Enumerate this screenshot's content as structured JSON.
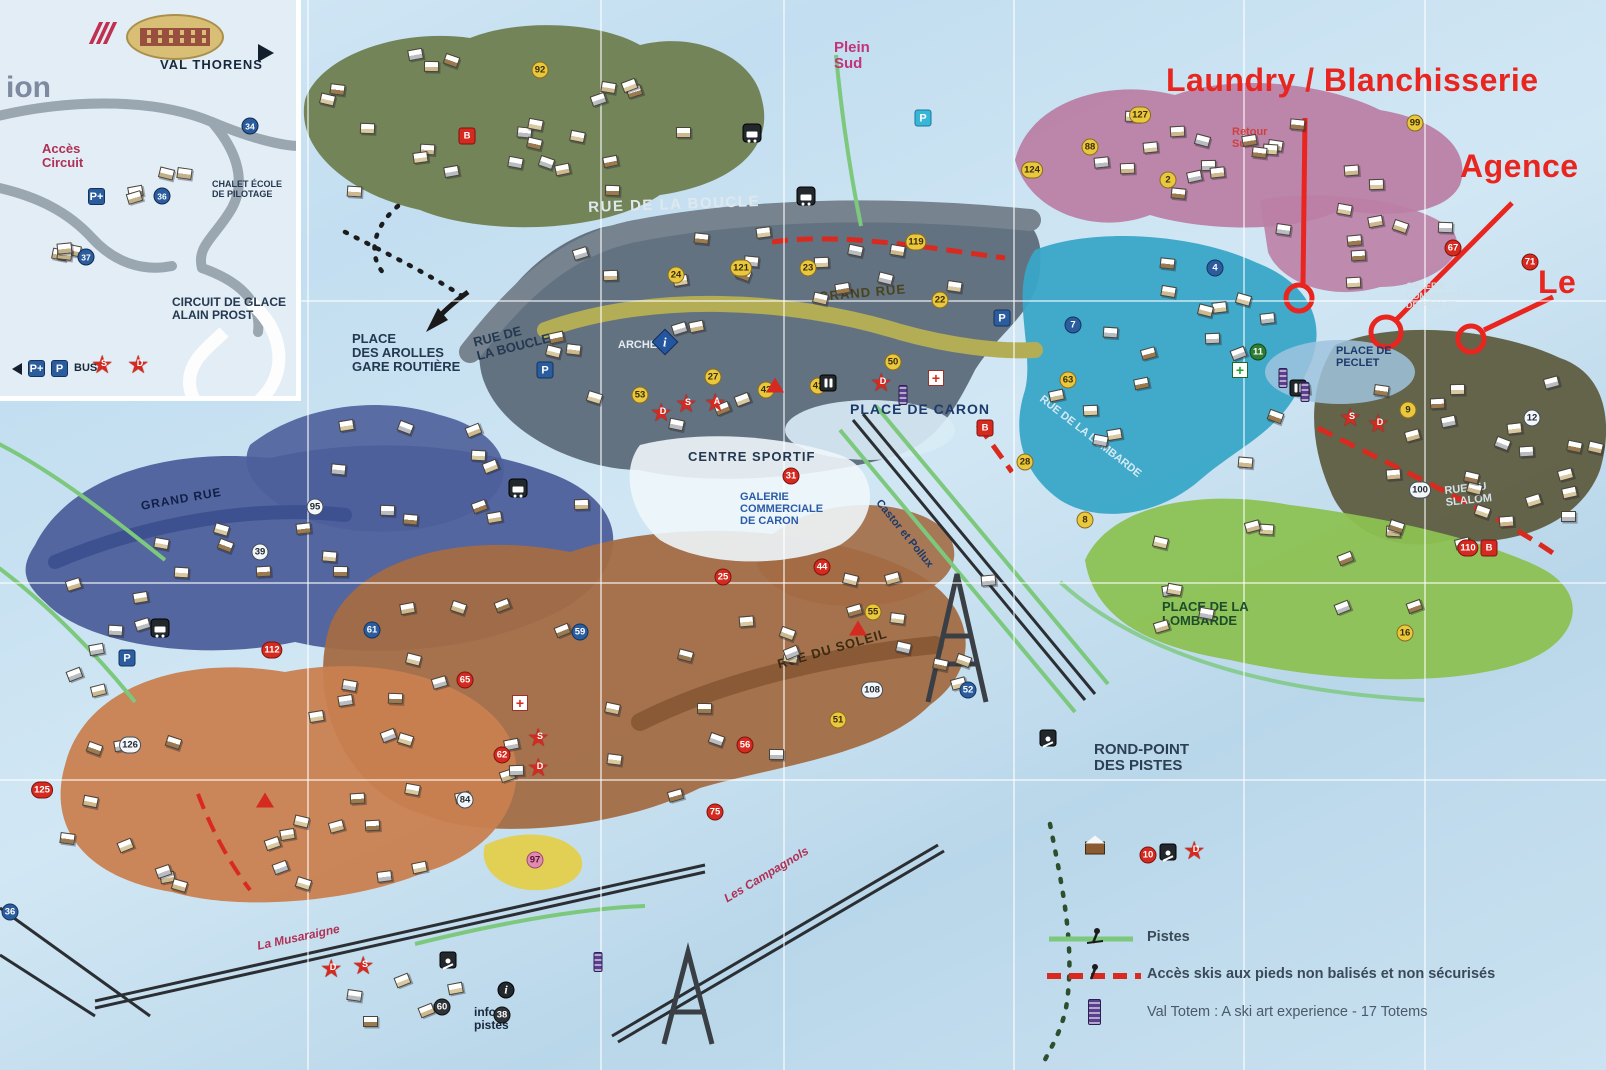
{
  "annotations": {
    "laundry": "Laundry / Blanchisserie",
    "agence": "Agence",
    "le": "Le"
  },
  "inset": {
    "val_thorens": "VAL THORENS",
    "partial_left": "ion",
    "acces_circuit": "Accès\nCircuit",
    "chalet_ecole": "CHALET ÉCOLE\nDE PILOTAGE",
    "circuit_glace": "CIRCUIT DE GLACE\nALAIN PROST",
    "p_plus": "P+",
    "p": "P",
    "bus": "BUS",
    "numbers": [
      {
        "n": "34",
        "x": 250,
        "y": 126
      },
      {
        "n": "36",
        "x": 162,
        "y": 196
      },
      {
        "n": "37",
        "x": 86,
        "y": 257
      }
    ],
    "stars": [
      {
        "l": "S",
        "x": 104,
        "y": 369
      },
      {
        "l": "D",
        "x": 140,
        "y": 369
      }
    ]
  },
  "legend": {
    "items": [
      {
        "type": "piste",
        "text": "Pistes"
      },
      {
        "type": "acces",
        "text": "Accès skis aux pieds non balisés et non sécurisés"
      },
      {
        "type": "totem",
        "text": "Val Totem : A ski art experience - 17 Totems"
      }
    ]
  },
  "zone_colors": {
    "olive": "#6f7e50",
    "pink": "#bb7fa5",
    "gray": "#5d6b7a",
    "cyan": "#39a6c8",
    "olive_dark": "#5e5d40",
    "green": "#8cc152",
    "blue": "#4d5f9a",
    "brown": "#a36c45",
    "orange": "#c9804f",
    "yellow": "#e3cf4a",
    "plaza": "#d8ecf6",
    "plaza2": "#eef6fb",
    "plaza3": "#9fc4de",
    "road_gray": "#77848f",
    "grand_rue_band": "#b3ad56",
    "soleil_road": "#8a5a36",
    "left_road": "#3d5090",
    "piste_green": "#7cc87c",
    "lift_black": "#2b2f33",
    "annotation_red": "#e8251f",
    "dash_red": "#d92a20",
    "footprint_black": "#1c1c1c",
    "footprint_green": "#2e4e2e"
  },
  "render": {
    "labels": [
      {
        "t": "RUE DE LA BOUCLE",
        "x": 588,
        "y": 200,
        "s": 15,
        "c": "#dfe8ee",
        "r": -2,
        "ls": 1.5
      },
      {
        "t": "GRAND RUE",
        "x": 818,
        "y": 290,
        "s": 13,
        "c": "#4a431a",
        "r": -5,
        "ls": 1
      },
      {
        "t": "RUE DE\nLA BOUCLE",
        "x": 472,
        "y": 336,
        "s": 13,
        "c": "#243850",
        "r": -14
      },
      {
        "t": "PLACE\nDES AROLLES\nGARE ROUTIÈRE",
        "x": 352,
        "y": 332,
        "s": 13,
        "c": "#243850"
      },
      {
        "t": "ARCHE",
        "x": 618,
        "y": 340,
        "s": 11,
        "c": "#e4ecf2"
      },
      {
        "t": "PLACE DE CARON",
        "x": 850,
        "y": 402,
        "s": 14,
        "c": "#1c3a6b",
        "ls": 1
      },
      {
        "t": "CENTRE SPORTIF",
        "x": 688,
        "y": 450,
        "s": 13,
        "c": "#243850",
        "ls": 1
      },
      {
        "t": "GALERIE\nCOMMERCIALE\nDE CARON",
        "x": 740,
        "y": 492,
        "s": 11,
        "c": "#2a5ba8"
      },
      {
        "t": "RUE DE LA LOMBARDE",
        "x": 1044,
        "y": 394,
        "s": 11,
        "c": "#d6eaf4",
        "r": 38
      },
      {
        "t": "PLACE DE\nPECLET",
        "x": 1336,
        "y": 346,
        "s": 11,
        "c": "#1c3a6b"
      },
      {
        "t": "GALERIE\nCOMMERCIALE\nDE PECLET",
        "x": 1406,
        "y": 282,
        "s": 9,
        "c": "#cfe0ea"
      },
      {
        "t": "RUE DU\nSLALOM",
        "x": 1444,
        "y": 486,
        "s": 11,
        "c": "#d6e2ea",
        "r": -6
      },
      {
        "t": "RUE DU SOLEIL",
        "x": 776,
        "y": 658,
        "s": 13,
        "c": "#3a2a12",
        "r": -16,
        "ls": 1
      },
      {
        "t": "PLACE DE LA\nLOMBARDE",
        "x": 1162,
        "y": 600,
        "s": 13,
        "c": "#1d4d2a"
      },
      {
        "t": "ROND-POINT\nDES PISTES",
        "x": 1094,
        "y": 742,
        "s": 15,
        "c": "#2d3f54"
      },
      {
        "t": "Plein\nSud",
        "x": 834,
        "y": 40,
        "s": 15,
        "c": "#c2337a"
      },
      {
        "t": "Retour\nSud",
        "x": 1232,
        "y": 127,
        "s": 11,
        "c": "#cf4040"
      },
      {
        "t": "infos\npistes",
        "x": 474,
        "y": 1006,
        "s": 12,
        "c": "#16283a"
      },
      {
        "t": "La Musaraigne",
        "x": 256,
        "y": 940,
        "s": 12,
        "c": "#b03055",
        "r": -12,
        "i": 1
      },
      {
        "t": "Les Campagnols",
        "x": 722,
        "y": 894,
        "s": 12,
        "c": "#b03055",
        "r": -31,
        "i": 1
      },
      {
        "t": "Castor et Pollux",
        "x": 882,
        "y": 498,
        "s": 11,
        "c": "#1c3a6b",
        "r": 51
      },
      {
        "t": "GRAND RUE",
        "x": 140,
        "y": 500,
        "s": 12,
        "c": "#101f46",
        "r": -10,
        "ls": 1
      }
    ],
    "building_markers": [
      {
        "n": "92",
        "x": 540,
        "y": 70,
        "c": "y"
      },
      {
        "n": "119",
        "x": 916,
        "y": 242,
        "c": "y"
      },
      {
        "n": "121",
        "x": 741,
        "y": 268,
        "c": "y"
      },
      {
        "n": "24",
        "x": 676,
        "y": 275,
        "c": "y"
      },
      {
        "n": "23",
        "x": 808,
        "y": 268,
        "c": "y"
      },
      {
        "n": "22",
        "x": 940,
        "y": 300,
        "c": "y"
      },
      {
        "n": "127",
        "x": 1140,
        "y": 115,
        "c": "y"
      },
      {
        "n": "88",
        "x": 1090,
        "y": 147,
        "c": "y"
      },
      {
        "n": "124",
        "x": 1032,
        "y": 170,
        "c": "y"
      },
      {
        "n": "2",
        "x": 1168,
        "y": 180,
        "c": "y"
      },
      {
        "n": "99",
        "x": 1415,
        "y": 123,
        "c": "y"
      },
      {
        "n": "67",
        "x": 1453,
        "y": 248,
        "c": "r"
      },
      {
        "n": "71",
        "x": 1530,
        "y": 262,
        "c": "r"
      },
      {
        "n": "4",
        "x": 1215,
        "y": 268,
        "c": "b"
      },
      {
        "n": "7",
        "x": 1073,
        "y": 325,
        "c": "b"
      },
      {
        "n": "63",
        "x": 1068,
        "y": 380,
        "c": "y"
      },
      {
        "n": "11",
        "x": 1258,
        "y": 352,
        "c": "g"
      },
      {
        "n": "50",
        "x": 893,
        "y": 362,
        "c": "y"
      },
      {
        "n": "41",
        "x": 818,
        "y": 386,
        "c": "y"
      },
      {
        "n": "42",
        "x": 766,
        "y": 390,
        "c": "y"
      },
      {
        "n": "53",
        "x": 640,
        "y": 395,
        "c": "y"
      },
      {
        "n": "27",
        "x": 713,
        "y": 377,
        "c": "y"
      },
      {
        "n": "31",
        "x": 791,
        "y": 476,
        "c": "r"
      },
      {
        "n": "25",
        "x": 723,
        "y": 577,
        "c": "r"
      },
      {
        "n": "44",
        "x": 822,
        "y": 567,
        "c": "r"
      },
      {
        "n": "95",
        "x": 315,
        "y": 507,
        "c": "w"
      },
      {
        "n": "39",
        "x": 260,
        "y": 552,
        "c": "w"
      },
      {
        "n": "55",
        "x": 873,
        "y": 612,
        "c": "y"
      },
      {
        "n": "28",
        "x": 1025,
        "y": 462,
        "c": "y"
      },
      {
        "n": "8",
        "x": 1085,
        "y": 520,
        "c": "y"
      },
      {
        "n": "16",
        "x": 1405,
        "y": 633,
        "c": "y"
      },
      {
        "n": "9",
        "x": 1408,
        "y": 410,
        "c": "y"
      },
      {
        "n": "100",
        "x": 1420,
        "y": 490,
        "c": "w"
      },
      {
        "n": "110",
        "x": 1468,
        "y": 548,
        "c": "r"
      },
      {
        "n": "12",
        "x": 1532,
        "y": 418,
        "c": "w"
      },
      {
        "n": "61",
        "x": 372,
        "y": 630,
        "c": "b"
      },
      {
        "n": "59",
        "x": 580,
        "y": 632,
        "c": "b"
      },
      {
        "n": "112",
        "x": 272,
        "y": 650,
        "c": "r"
      },
      {
        "n": "65",
        "x": 465,
        "y": 680,
        "c": "r"
      },
      {
        "n": "62",
        "x": 502,
        "y": 755,
        "c": "r"
      },
      {
        "n": "84",
        "x": 465,
        "y": 800,
        "c": "w"
      },
      {
        "n": "56",
        "x": 745,
        "y": 745,
        "c": "r"
      },
      {
        "n": "51",
        "x": 838,
        "y": 720,
        "c": "y"
      },
      {
        "n": "108",
        "x": 872,
        "y": 690,
        "c": "w"
      },
      {
        "n": "52",
        "x": 968,
        "y": 690,
        "c": "b"
      },
      {
        "n": "75",
        "x": 715,
        "y": 812,
        "c": "r"
      },
      {
        "n": "97",
        "x": 535,
        "y": 860,
        "c": "p"
      },
      {
        "n": "126",
        "x": 130,
        "y": 745,
        "c": "w"
      },
      {
        "n": "125",
        "x": 42,
        "y": 790,
        "c": "r"
      },
      {
        "n": "10",
        "x": 1148,
        "y": 855,
        "c": "r"
      },
      {
        "n": "38",
        "x": 502,
        "y": 1015,
        "c": "dk"
      },
      {
        "n": "60",
        "x": 442,
        "y": 1007,
        "c": "dk"
      },
      {
        "n": "36",
        "x": 10,
        "y": 912,
        "c": "b"
      },
      {
        "n": "B",
        "x": 467,
        "y": 136,
        "c": "rs"
      },
      {
        "n": "B",
        "x": 985,
        "y": 428,
        "c": "rs"
      },
      {
        "n": "B",
        "x": 1489,
        "y": 548,
        "c": "rs"
      }
    ],
    "marker_colors": {
      "y": {
        "bg": "#e9c83d",
        "fg": "#3a2c0a",
        "bd": "#8a6d1f"
      },
      "r": {
        "bg": "#d42a20",
        "fg": "#ffffff",
        "bd": "#7e1410"
      },
      "w": {
        "bg": "#f4f7f9",
        "fg": "#222a33",
        "bd": "#44505c"
      },
      "b": {
        "bg": "#2b5d9e",
        "fg": "#ffffff",
        "bd": "#16345e"
      },
      "dk": {
        "bg": "#2e3338",
        "fg": "#ffffff",
        "bd": "#111111"
      },
      "g": {
        "bg": "#2e7d32",
        "fg": "#ffffff",
        "bd": "#14481a"
      },
      "p": {
        "bg": "#e08cb0",
        "fg": "#5e1030",
        "bd": "#a04a72"
      },
      "rs": {
        "bg": "#d42a20",
        "fg": "#ffffff",
        "bd": "#7e1410"
      }
    },
    "stars": [
      {
        "l": "D",
        "x": 663,
        "y": 417
      },
      {
        "l": "S",
        "x": 688,
        "y": 408
      },
      {
        "l": "A",
        "x": 717,
        "y": 407
      },
      {
        "l": "D",
        "x": 883,
        "y": 387
      },
      {
        "l": "S",
        "x": 540,
        "y": 742
      },
      {
        "l": "D",
        "x": 540,
        "y": 772
      },
      {
        "l": "D",
        "x": 333,
        "y": 973
      },
      {
        "l": "S",
        "x": 365,
        "y": 970
      },
      {
        "l": "S",
        "x": 1352,
        "y": 422
      },
      {
        "l": "D",
        "x": 1380,
        "y": 428
      },
      {
        "l": "D",
        "x": 1196,
        "y": 855
      }
    ],
    "triangles": [
      {
        "x": 775,
        "y": 385
      },
      {
        "x": 858,
        "y": 628
      },
      {
        "x": 265,
        "y": 800
      }
    ],
    "icons": {
      "parking": [
        {
          "x": 545,
          "y": 370,
          "label": "P"
        },
        {
          "x": 923,
          "y": 118,
          "label": "P",
          "variant": "cyan"
        },
        {
          "x": 127,
          "y": 658,
          "label": "P"
        },
        {
          "x": 1002,
          "y": 318,
          "label": "P"
        }
      ],
      "bus": [
        {
          "x": 752,
          "y": 133
        },
        {
          "x": 806,
          "y": 196
        },
        {
          "x": 160,
          "y": 628
        },
        {
          "x": 518,
          "y": 488
        }
      ],
      "wc": [
        {
          "x": 828,
          "y": 383
        },
        {
          "x": 1298,
          "y": 388
        }
      ],
      "aid": [
        {
          "x": 936,
          "y": 378
        },
        {
          "x": 520,
          "y": 703
        }
      ],
      "pharmacy": [
        {
          "x": 1240,
          "y": 370
        }
      ],
      "info_diamond": [
        {
          "x": 665,
          "y": 342
        }
      ],
      "info_circle": [
        {
          "x": 506,
          "y": 990
        }
      ],
      "totem": [
        {
          "x": 903,
          "y": 395
        },
        {
          "x": 1283,
          "y": 378
        },
        {
          "x": 1305,
          "y": 392
        },
        {
          "x": 598,
          "y": 962
        }
      ],
      "ski": [
        {
          "x": 1048,
          "y": 738
        },
        {
          "x": 1168,
          "y": 852
        },
        {
          "x": 448,
          "y": 960
        }
      ],
      "chalet": [
        {
          "x": 1095,
          "y": 848
        }
      ]
    },
    "clusters": [
      {
        "x": 320,
        "y": 45,
        "w": 380,
        "h": 150,
        "n": 24
      },
      {
        "x": 1040,
        "y": 95,
        "w": 360,
        "h": 110,
        "n": 16
      },
      {
        "x": 1270,
        "y": 175,
        "w": 180,
        "h": 110,
        "n": 9
      },
      {
        "x": 560,
        "y": 225,
        "w": 400,
        "h": 70,
        "n": 14
      },
      {
        "x": 1045,
        "y": 255,
        "w": 260,
        "h": 210,
        "n": 18
      },
      {
        "x": 1350,
        "y": 360,
        "w": 230,
        "h": 160,
        "n": 13
      },
      {
        "x": 60,
        "y": 520,
        "w": 270,
        "h": 170,
        "n": 14
      },
      {
        "x": 330,
        "y": 420,
        "w": 250,
        "h": 150,
        "n": 12
      },
      {
        "x": 545,
        "y": 320,
        "w": 190,
        "h": 110,
        "n": 9
      },
      {
        "x": 400,
        "y": 600,
        "w": 400,
        "h": 200,
        "n": 22
      },
      {
        "x": 820,
        "y": 555,
        "w": 170,
        "h": 130,
        "n": 9
      },
      {
        "x": 60,
        "y": 680,
        "w": 370,
        "h": 210,
        "n": 18
      },
      {
        "x": 1150,
        "y": 520,
        "w": 320,
        "h": 110,
        "n": 12
      },
      {
        "x": 330,
        "y": 975,
        "w": 130,
        "h": 60,
        "n": 5
      },
      {
        "x": 230,
        "y": 790,
        "w": 150,
        "h": 90,
        "n": 7
      },
      {
        "x": 1430,
        "y": 420,
        "w": 160,
        "h": 120,
        "n": 8
      }
    ],
    "inset_clusters": [
      {
        "x": 110,
        "y": 158,
        "w": 70,
        "h": 40,
        "n": 4
      },
      {
        "x": 10,
        "y": 210,
        "w": 60,
        "h": 50,
        "n": 4
      }
    ],
    "grid": {
      "vertical": [
        307,
        600,
        783,
        1013,
        1243,
        1424
      ],
      "horizontal": [
        300,
        582,
        779
      ]
    }
  }
}
